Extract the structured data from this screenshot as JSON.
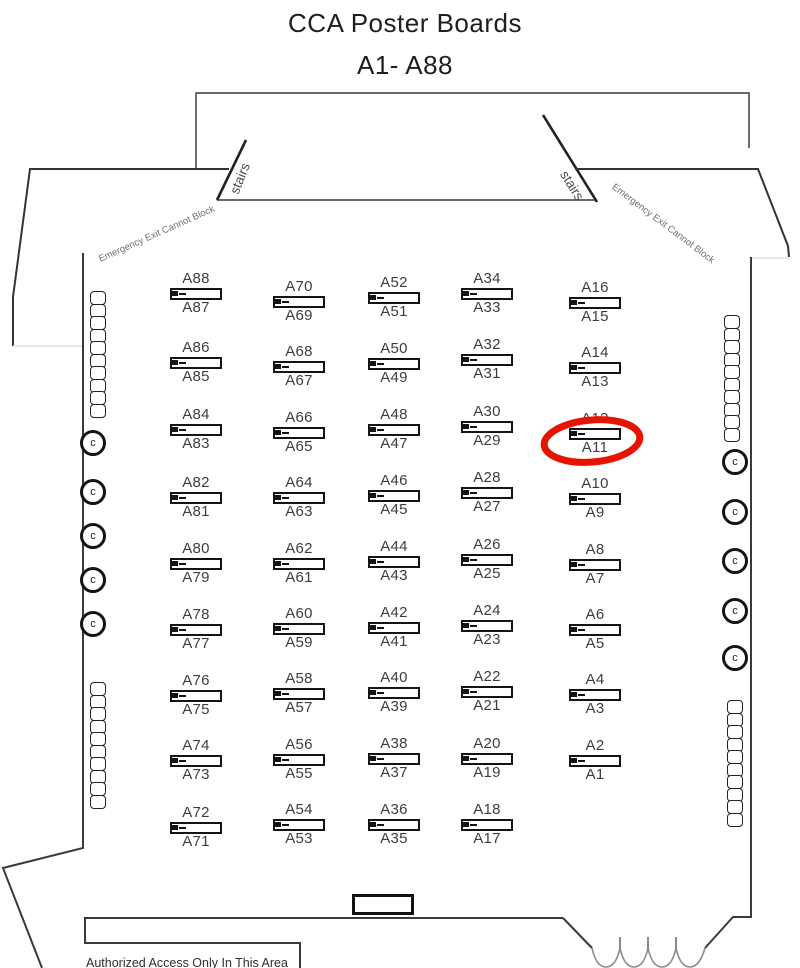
{
  "title": {
    "line1": "CCA Poster Boards",
    "line2": "A1- A88"
  },
  "room_labels": {
    "stairs_left": "stairs",
    "stairs_right": "stairs",
    "emergency_left": "Emergency Exit Cannot Block",
    "emergency_right": "Emergency Exit Cannot Block",
    "authorized_area": "Authorized Access Only In This Area",
    "chair_symbol": "c"
  },
  "annotation": {
    "highlighted_board": "A11",
    "color": "#e51400"
  },
  "colors": {
    "wall": "#333333",
    "stage_line": "#555555",
    "board_border": "#141414",
    "label_text": "#3d3d3d",
    "highlight_red": "#e51400",
    "threshold_light": "#e0e0e0",
    "curtain_gray": "#8a8a8a"
  },
  "board_columns": [
    {
      "x": 196,
      "rows": [
        {
          "top": "A88",
          "bottom": "A87",
          "y": 272
        },
        {
          "top": "A86",
          "bottom": "A85",
          "y": 341
        },
        {
          "top": "A84",
          "bottom": "A83",
          "y": 408
        },
        {
          "top": "A82",
          "bottom": "A81",
          "y": 476
        },
        {
          "top": "A80",
          "bottom": "A79",
          "y": 542
        },
        {
          "top": "A78",
          "bottom": "A77",
          "y": 608
        },
        {
          "top": "A76",
          "bottom": "A75",
          "y": 674
        },
        {
          "top": "A74",
          "bottom": "A73",
          "y": 739
        },
        {
          "top": "A72",
          "bottom": "A71",
          "y": 806
        }
      ]
    },
    {
      "x": 299,
      "rows": [
        {
          "top": "A70",
          "bottom": "A69",
          "y": 280
        },
        {
          "top": "A68",
          "bottom": "A67",
          "y": 345
        },
        {
          "top": "A66",
          "bottom": "A65",
          "y": 411
        },
        {
          "top": "A64",
          "bottom": "A63",
          "y": 476
        },
        {
          "top": "A62",
          "bottom": "A61",
          "y": 542
        },
        {
          "top": "A60",
          "bottom": "A59",
          "y": 607
        },
        {
          "top": "A58",
          "bottom": "A57",
          "y": 672
        },
        {
          "top": "A56",
          "bottom": "A55",
          "y": 738
        },
        {
          "top": "A54",
          "bottom": "A53",
          "y": 803
        }
      ]
    },
    {
      "x": 394,
      "rows": [
        {
          "top": "A52",
          "bottom": "A51",
          "y": 276
        },
        {
          "top": "A50",
          "bottom": "A49",
          "y": 342
        },
        {
          "top": "A48",
          "bottom": "A47",
          "y": 408
        },
        {
          "top": "A46",
          "bottom": "A45",
          "y": 474
        },
        {
          "top": "A44",
          "bottom": "A43",
          "y": 540
        },
        {
          "top": "A42",
          "bottom": "A41",
          "y": 606
        },
        {
          "top": "A40",
          "bottom": "A39",
          "y": 671
        },
        {
          "top": "A38",
          "bottom": "A37",
          "y": 737
        },
        {
          "top": "A36",
          "bottom": "A35",
          "y": 803
        }
      ]
    },
    {
      "x": 487,
      "rows": [
        {
          "top": "A34",
          "bottom": "A33",
          "y": 272
        },
        {
          "top": "A32",
          "bottom": "A31",
          "y": 338
        },
        {
          "top": "A30",
          "bottom": "A29",
          "y": 405
        },
        {
          "top": "A28",
          "bottom": "A27",
          "y": 471
        },
        {
          "top": "A26",
          "bottom": "A25",
          "y": 538
        },
        {
          "top": "A24",
          "bottom": "A23",
          "y": 604
        },
        {
          "top": "A22",
          "bottom": "A21",
          "y": 670
        },
        {
          "top": "A20",
          "bottom": "A19",
          "y": 737
        },
        {
          "top": "A18",
          "bottom": "A17",
          "y": 803
        }
      ]
    },
    {
      "x": 595,
      "rows": [
        {
          "top": "A16",
          "bottom": "A15",
          "y": 281
        },
        {
          "top": "A14",
          "bottom": "A13",
          "y": 346
        },
        {
          "top": "A12",
          "bottom": "A11",
          "y": 412
        },
        {
          "top": "A10",
          "bottom": "A9",
          "y": 477
        },
        {
          "top": "A8",
          "bottom": "A7",
          "y": 543
        },
        {
          "top": "A6",
          "bottom": "A5",
          "y": 608
        },
        {
          "top": "A4",
          "bottom": "A3",
          "y": 673
        },
        {
          "top": "A2",
          "bottom": "A1",
          "y": 739
        }
      ]
    }
  ],
  "furniture": {
    "chair_stacks": [
      {
        "x": 90,
        "y": 291,
        "count": 10
      },
      {
        "x": 90,
        "y": 682,
        "count": 10
      },
      {
        "x": 724,
        "y": 315,
        "count": 10
      },
      {
        "x": 727,
        "y": 700,
        "count": 10
      }
    ],
    "outlet_circles": [
      {
        "x": 93,
        "y": 443
      },
      {
        "x": 93,
        "y": 492
      },
      {
        "x": 93,
        "y": 536
      },
      {
        "x": 93,
        "y": 580
      },
      {
        "x": 93,
        "y": 624
      },
      {
        "x": 735,
        "y": 462
      },
      {
        "x": 735,
        "y": 512
      },
      {
        "x": 735,
        "y": 561
      },
      {
        "x": 735,
        "y": 611
      },
      {
        "x": 735,
        "y": 658
      }
    ]
  }
}
